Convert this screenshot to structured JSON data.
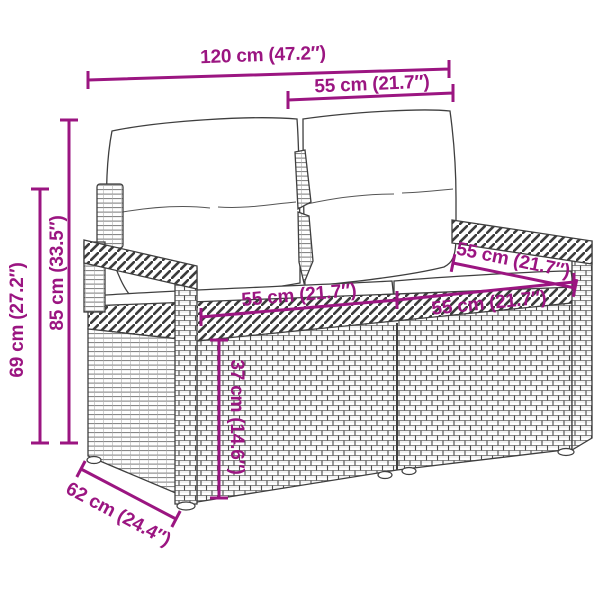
{
  "page": {
    "background": "#ffffff",
    "accent_color": "#9B1581",
    "line_art_color": "#3f3f3f"
  },
  "illustration": {
    "subject": "two-seater wicker garden loveseat with back cushions and seat cushions, black-and-white line art"
  },
  "dims": [
    {
      "id": "overall-width",
      "label": "120 cm (47.2″)"
    },
    {
      "id": "upper-width",
      "label": "55 cm (21.7″)"
    },
    {
      "id": "total-height",
      "label": "85 cm (33.5″)"
    },
    {
      "id": "secondary-height",
      "label": "69 cm (27.2″)"
    },
    {
      "id": "seat-width-left",
      "label": "55 cm (21.7″)"
    },
    {
      "id": "seat-width-right",
      "label": "55 cm (21.7″)"
    },
    {
      "id": "seat-depth",
      "label": "55 cm (21.7″)"
    },
    {
      "id": "base-height",
      "label": "37 cm (14.6″)"
    },
    {
      "id": "overall-depth",
      "label": "62 cm (24.4″)"
    }
  ]
}
